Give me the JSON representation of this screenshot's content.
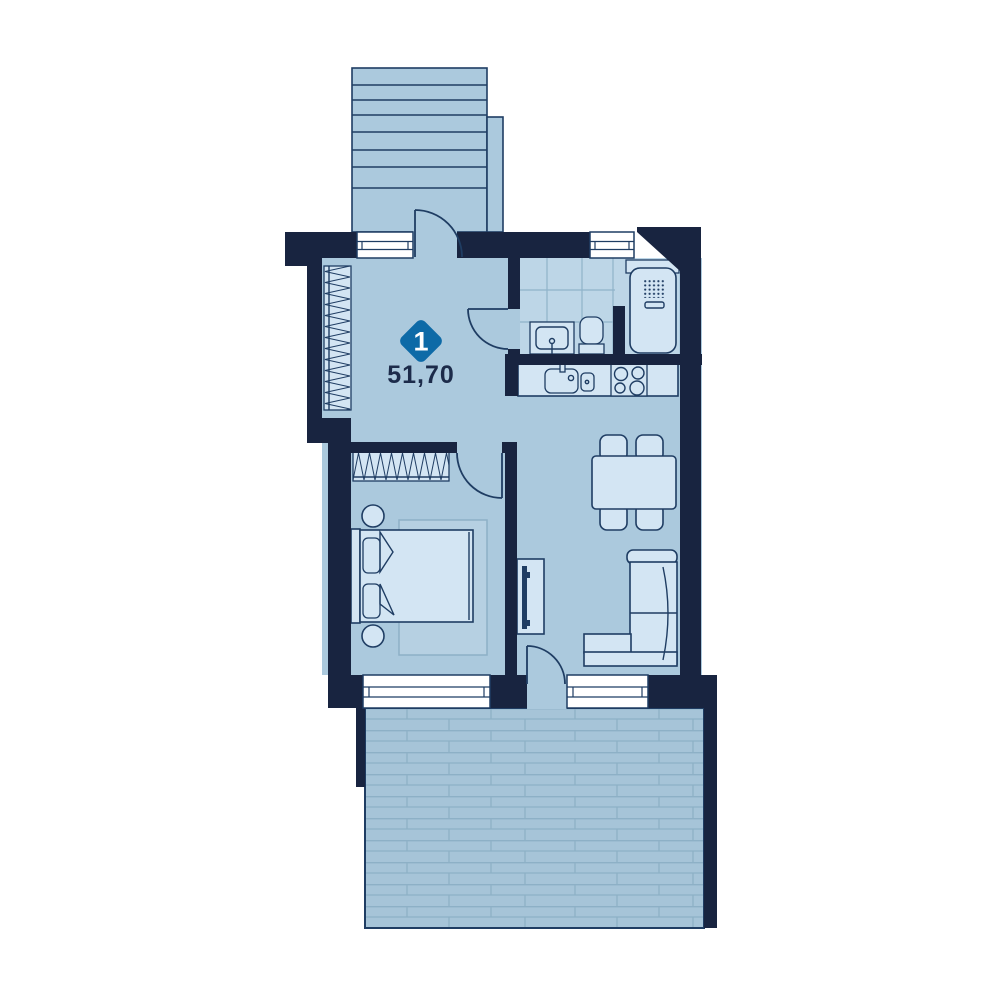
{
  "unit": {
    "badge_number": "1",
    "area_label": "51,70"
  },
  "colors": {
    "wall": "#182440",
    "floor": "#abc9dd",
    "furniture": "#d3e5f3",
    "tile": "#bdd6e7",
    "tile_line": "#8fb3c9",
    "outline": "#1f3d63",
    "terrace": "#a6c4d8",
    "terrace_line": "#8db0c6",
    "rug": "#b6d0e2",
    "window": "#ffffff",
    "badge": "#0d6aa7",
    "badge_text": "#ffffff",
    "label_text": "#1c2b4a"
  },
  "icons": [
    "stairs-icon",
    "entrance-door-icon",
    "hall-closet-icon",
    "bathroom-sink-icon",
    "toilet-icon",
    "water-heater-icon",
    "kitchen-sink-icon",
    "stove-icon",
    "dining-table-icon",
    "chair-icon",
    "sofa-icon",
    "tv-stand-icon",
    "bed-icon",
    "pillow-icon",
    "wardrobe-icon",
    "nightstand-icon",
    "rug-icon",
    "balcony-door-icon",
    "terrace-deck-icon",
    "window-icon"
  ]
}
